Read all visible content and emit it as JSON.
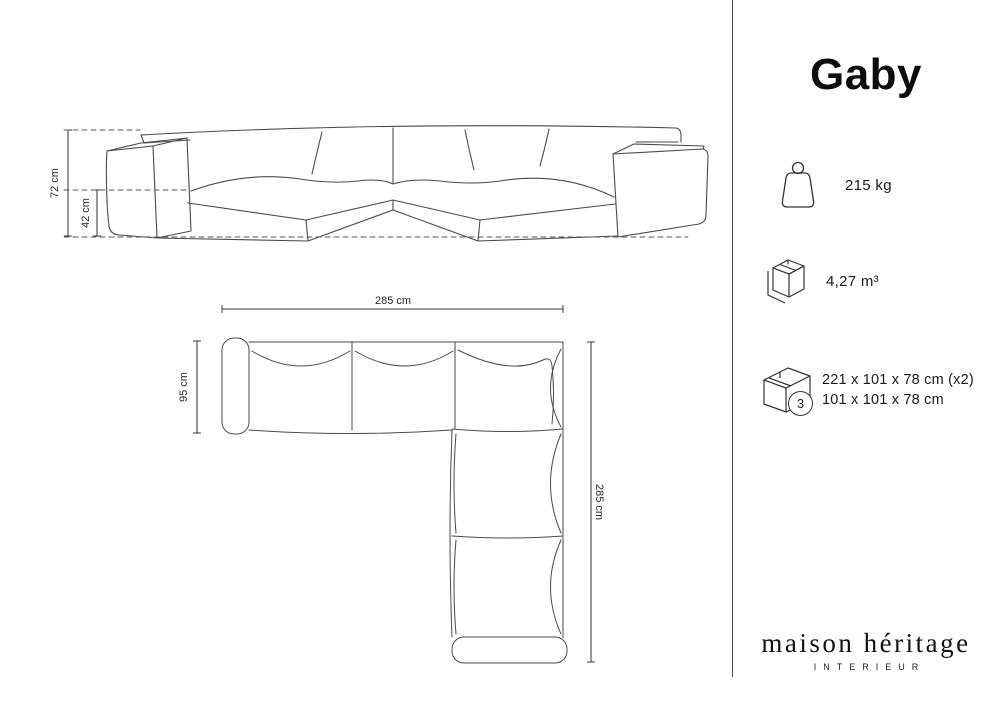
{
  "title": "Gaby",
  "specs": {
    "weight": {
      "value": "215 kg"
    },
    "volume": {
      "value": "4,27 m³"
    },
    "packaging": {
      "count": "3",
      "lines": [
        "221 x 101 x 78 cm (x2)",
        "101 x 101 x 78 cm"
      ]
    }
  },
  "diagram": {
    "front_view": {
      "height_label": "72 cm",
      "seat_height_label": "42 cm"
    },
    "top_view": {
      "width_label": "285 cm",
      "depth_label": "95 cm",
      "length_label": "285 cm"
    }
  },
  "brand": {
    "name": "maison héritage",
    "subtitle": "INTERIEUR"
  },
  "colors": {
    "line": "#4a4a4a",
    "dim_line": "#333333",
    "text": "#1a1a1a",
    "background": "#ffffff"
  }
}
